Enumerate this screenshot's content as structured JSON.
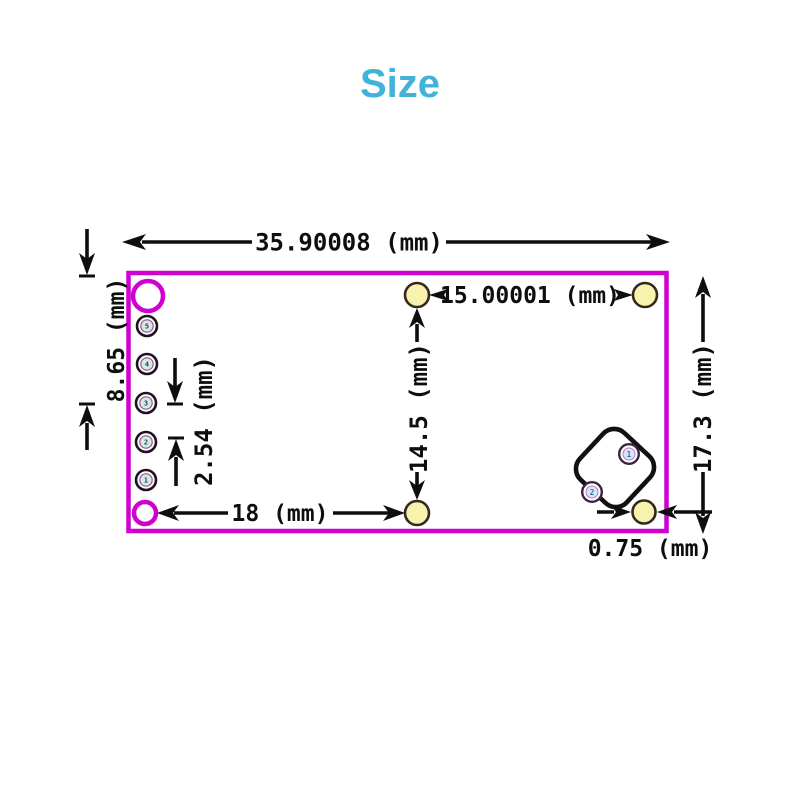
{
  "title": "Size",
  "theme": {
    "title_color": "#42b3d8",
    "board_outline_color": "#d000d0",
    "dimension_color": "#0e0e0e",
    "pad_fill": "#f7f2ae",
    "pad_stroke": "#35281c",
    "pin_inner_fill": "#d6e9e2",
    "module_circle_fill": "#d9e5f3"
  },
  "dims": {
    "board_width": "35.90008 (mm)",
    "pad_span_horizontal": "15.00001 (mm)",
    "left_edge_offset": "8.65 (mm)",
    "pin_pitch": "2.54 (mm)",
    "pad_span_vertical": "14.5 (mm)",
    "bottom_span": "18 (mm)",
    "board_height": "17.3 (mm)",
    "edge_gap": "0.75 (mm)"
  },
  "pins": [
    "5",
    "4",
    "3",
    "2",
    "1"
  ],
  "module_pins": [
    "1",
    "2"
  ]
}
